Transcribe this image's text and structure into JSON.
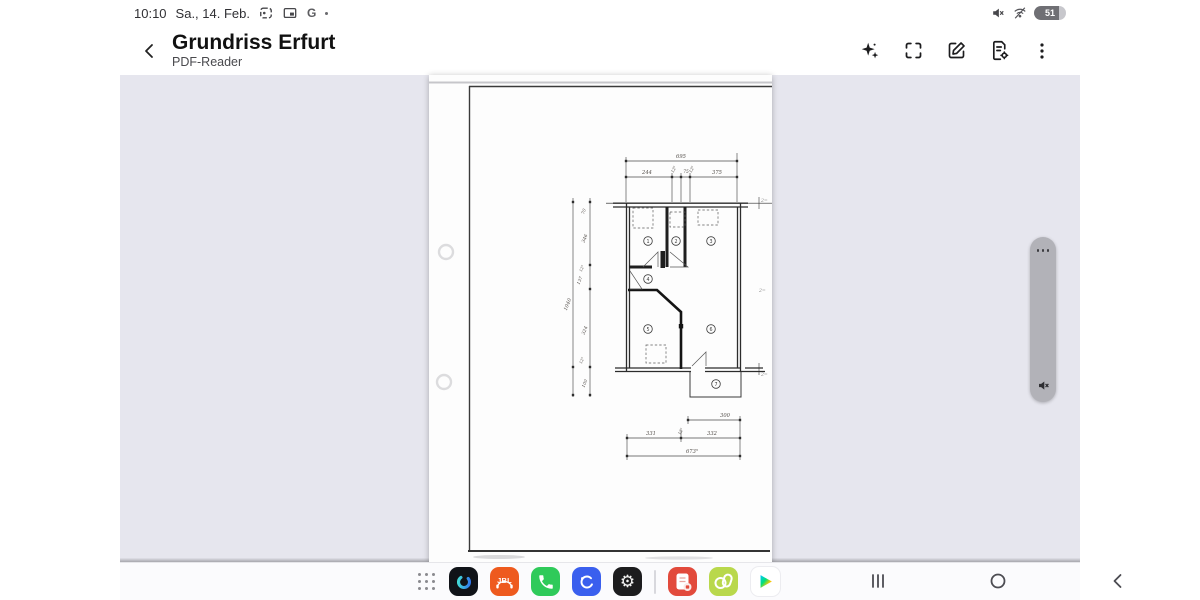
{
  "status_bar": {
    "time": "10:10",
    "date": "Sa., 14. Feb.",
    "google_badge": "G",
    "battery_level": "51"
  },
  "header": {
    "title": "Grundriss Erfurt",
    "subtitle": "PDF-Reader"
  },
  "document": {
    "dimensions": {
      "top_total": "695",
      "top_seg_1": "244",
      "top_seg_2": "12⁵",
      "top_seg_3": "75",
      "top_seg_4": "12⁵",
      "top_seg_5": "375",
      "left_seg_1": "70",
      "left_seg_2": "346",
      "left_seg_3": "12⁵",
      "left_seg_4": "137",
      "left_seg_5": "324",
      "left_seg_6": "12⁵",
      "left_seg_7": "100",
      "left_total": "1040",
      "bottom_top": "300",
      "bottom_seg_1": "331",
      "bottom_seg_2": "12⁵",
      "bottom_seg_3": "332",
      "bottom_total": "673⁵"
    },
    "rooms": {
      "r1": "1",
      "r2": "2",
      "r3": "3",
      "r4": "4",
      "r5": "5",
      "r6": "6",
      "r7": "7"
    },
    "margin_notes": {
      "n1": "2=",
      "n2": "2=",
      "n3": "2="
    }
  },
  "taskbar": {
    "jbl_label": "JBL",
    "settings_glyph": "⚙"
  },
  "colors": {
    "content_bg": "#e6e6ee",
    "edge_panel": "#b2b2b8",
    "phone_green": "#2fca5a",
    "internet_blue": "#3a5fee",
    "jbl_orange": "#ee5a1e",
    "notes_red": "#e24a3c",
    "lime_green": "#b9d84c",
    "dark_icon": "#17181c",
    "play_triangle": "#00c4ff,#00e07a,#ffc900,#ff3a44"
  }
}
